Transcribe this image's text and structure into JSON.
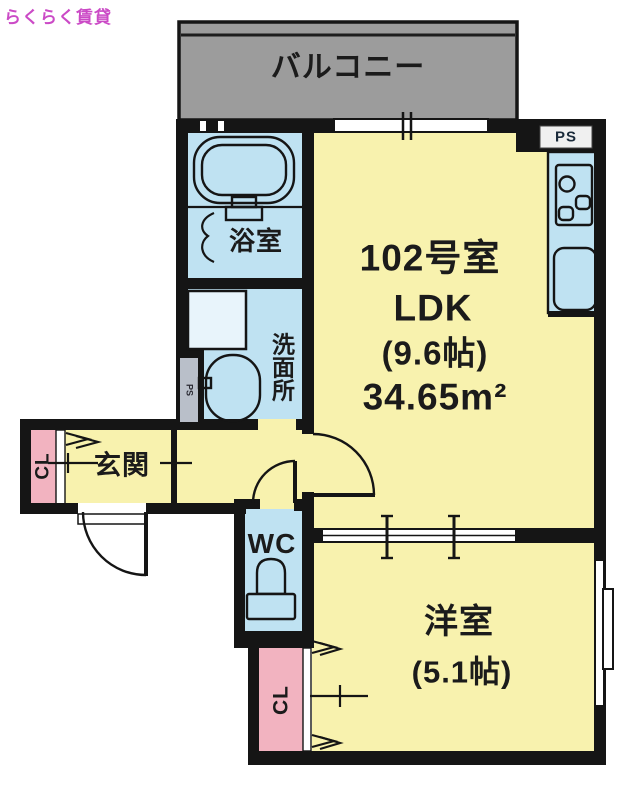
{
  "brand": "らくらく賃貸",
  "floorplan": {
    "balcony": "バルコニー",
    "bathroom": "浴室",
    "washroom": "洗面所",
    "pipe_space_left": "PS",
    "pipe_space_kitchen": "PS",
    "ldk": {
      "room_no": "102号室",
      "type": "LDK",
      "size": "(9.6帖)",
      "area": "34.65m²"
    },
    "entrance": "玄関",
    "closet_entrance": "CL",
    "toilet": "WC",
    "western_room": {
      "name": "洋室",
      "size": "(5.1帖)"
    },
    "closet_bedroom": "CL"
  },
  "colors": {
    "room_yellow": "#f8f2ae",
    "wet_blue": "#bfe2f2",
    "closet_pink": "#f2b3c0",
    "balcony_gray": "#9c9c9c",
    "wall_black": "#151515",
    "brand_magenta": "#cb4ac6"
  }
}
